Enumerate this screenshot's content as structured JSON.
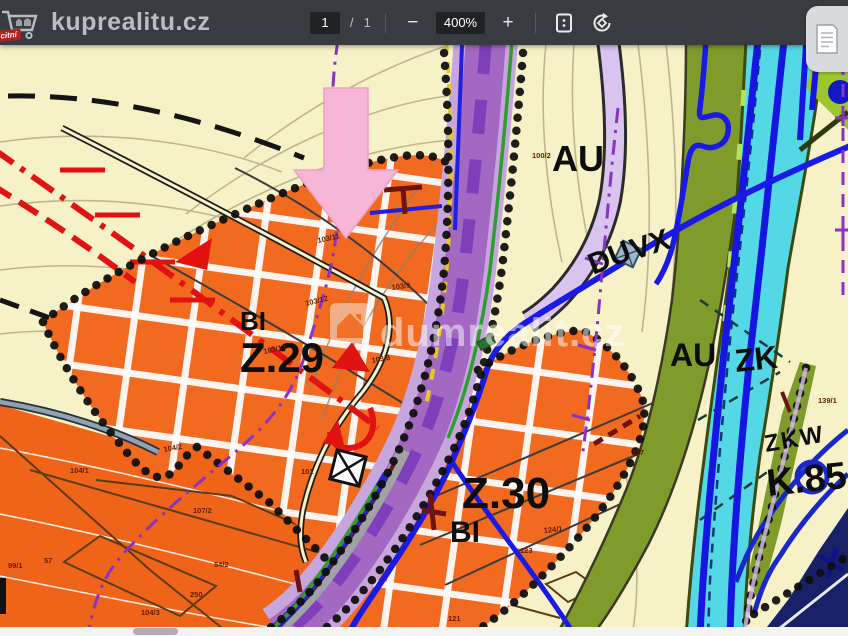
{
  "toolbar": {
    "logo": {
      "badge": "licitní",
      "text": "kuprealitu.cz"
    },
    "page": {
      "current": "1",
      "separator": "/",
      "total": "1"
    },
    "zoom": {
      "out": "−",
      "level": "400%",
      "in": "+"
    },
    "icons": {
      "logo": "shopping-cart-icon",
      "fit": "fit-to-page-icon",
      "rotate": "rotate-page-icon",
      "fab": "open-document-icon"
    }
  },
  "map": {
    "watermark": "dumrealit.cz",
    "zones": [
      {
        "text": "AU"
      },
      {
        "text": "DU"
      },
      {
        "text": "VX"
      },
      {
        "text": "AU"
      },
      {
        "text": "ZK"
      },
      {
        "text": "BI"
      },
      {
        "text": "Z.29"
      },
      {
        "text": "Z.30"
      },
      {
        "text": "BI"
      },
      {
        "text": "ZKW"
      },
      {
        "text": "K.85"
      }
    ],
    "parcels": [
      {
        "text": "100/2"
      },
      {
        "text": "103/9"
      },
      {
        "text": "103/12"
      },
      {
        "text": "103/13"
      },
      {
        "text": "103/8"
      },
      {
        "text": "103/11"
      },
      {
        "text": "104/1"
      },
      {
        "text": "104/2"
      },
      {
        "text": "99/1"
      },
      {
        "text": "57"
      },
      {
        "text": "107/2"
      },
      {
        "text": "54/2"
      },
      {
        "text": "250"
      },
      {
        "text": "104/3"
      },
      {
        "text": "117"
      },
      {
        "text": "124/1"
      },
      {
        "text": "123"
      },
      {
        "text": "139/1"
      },
      {
        "text": "101"
      },
      {
        "text": "121"
      }
    ]
  },
  "colors": {
    "toolbar_bg": "#383c41",
    "page_cream": "#f6f1c6",
    "zone_orange": "#f16a1f",
    "corridor_purple": "#a268c2",
    "corridor_lavender": "#c7a6de",
    "stream_cyan": "#55d8e6",
    "olive_green": "#7e9b2b",
    "marker_pink": "#f7b6d5",
    "line_blue": "#1a1ae6",
    "line_red": "#e01212"
  }
}
